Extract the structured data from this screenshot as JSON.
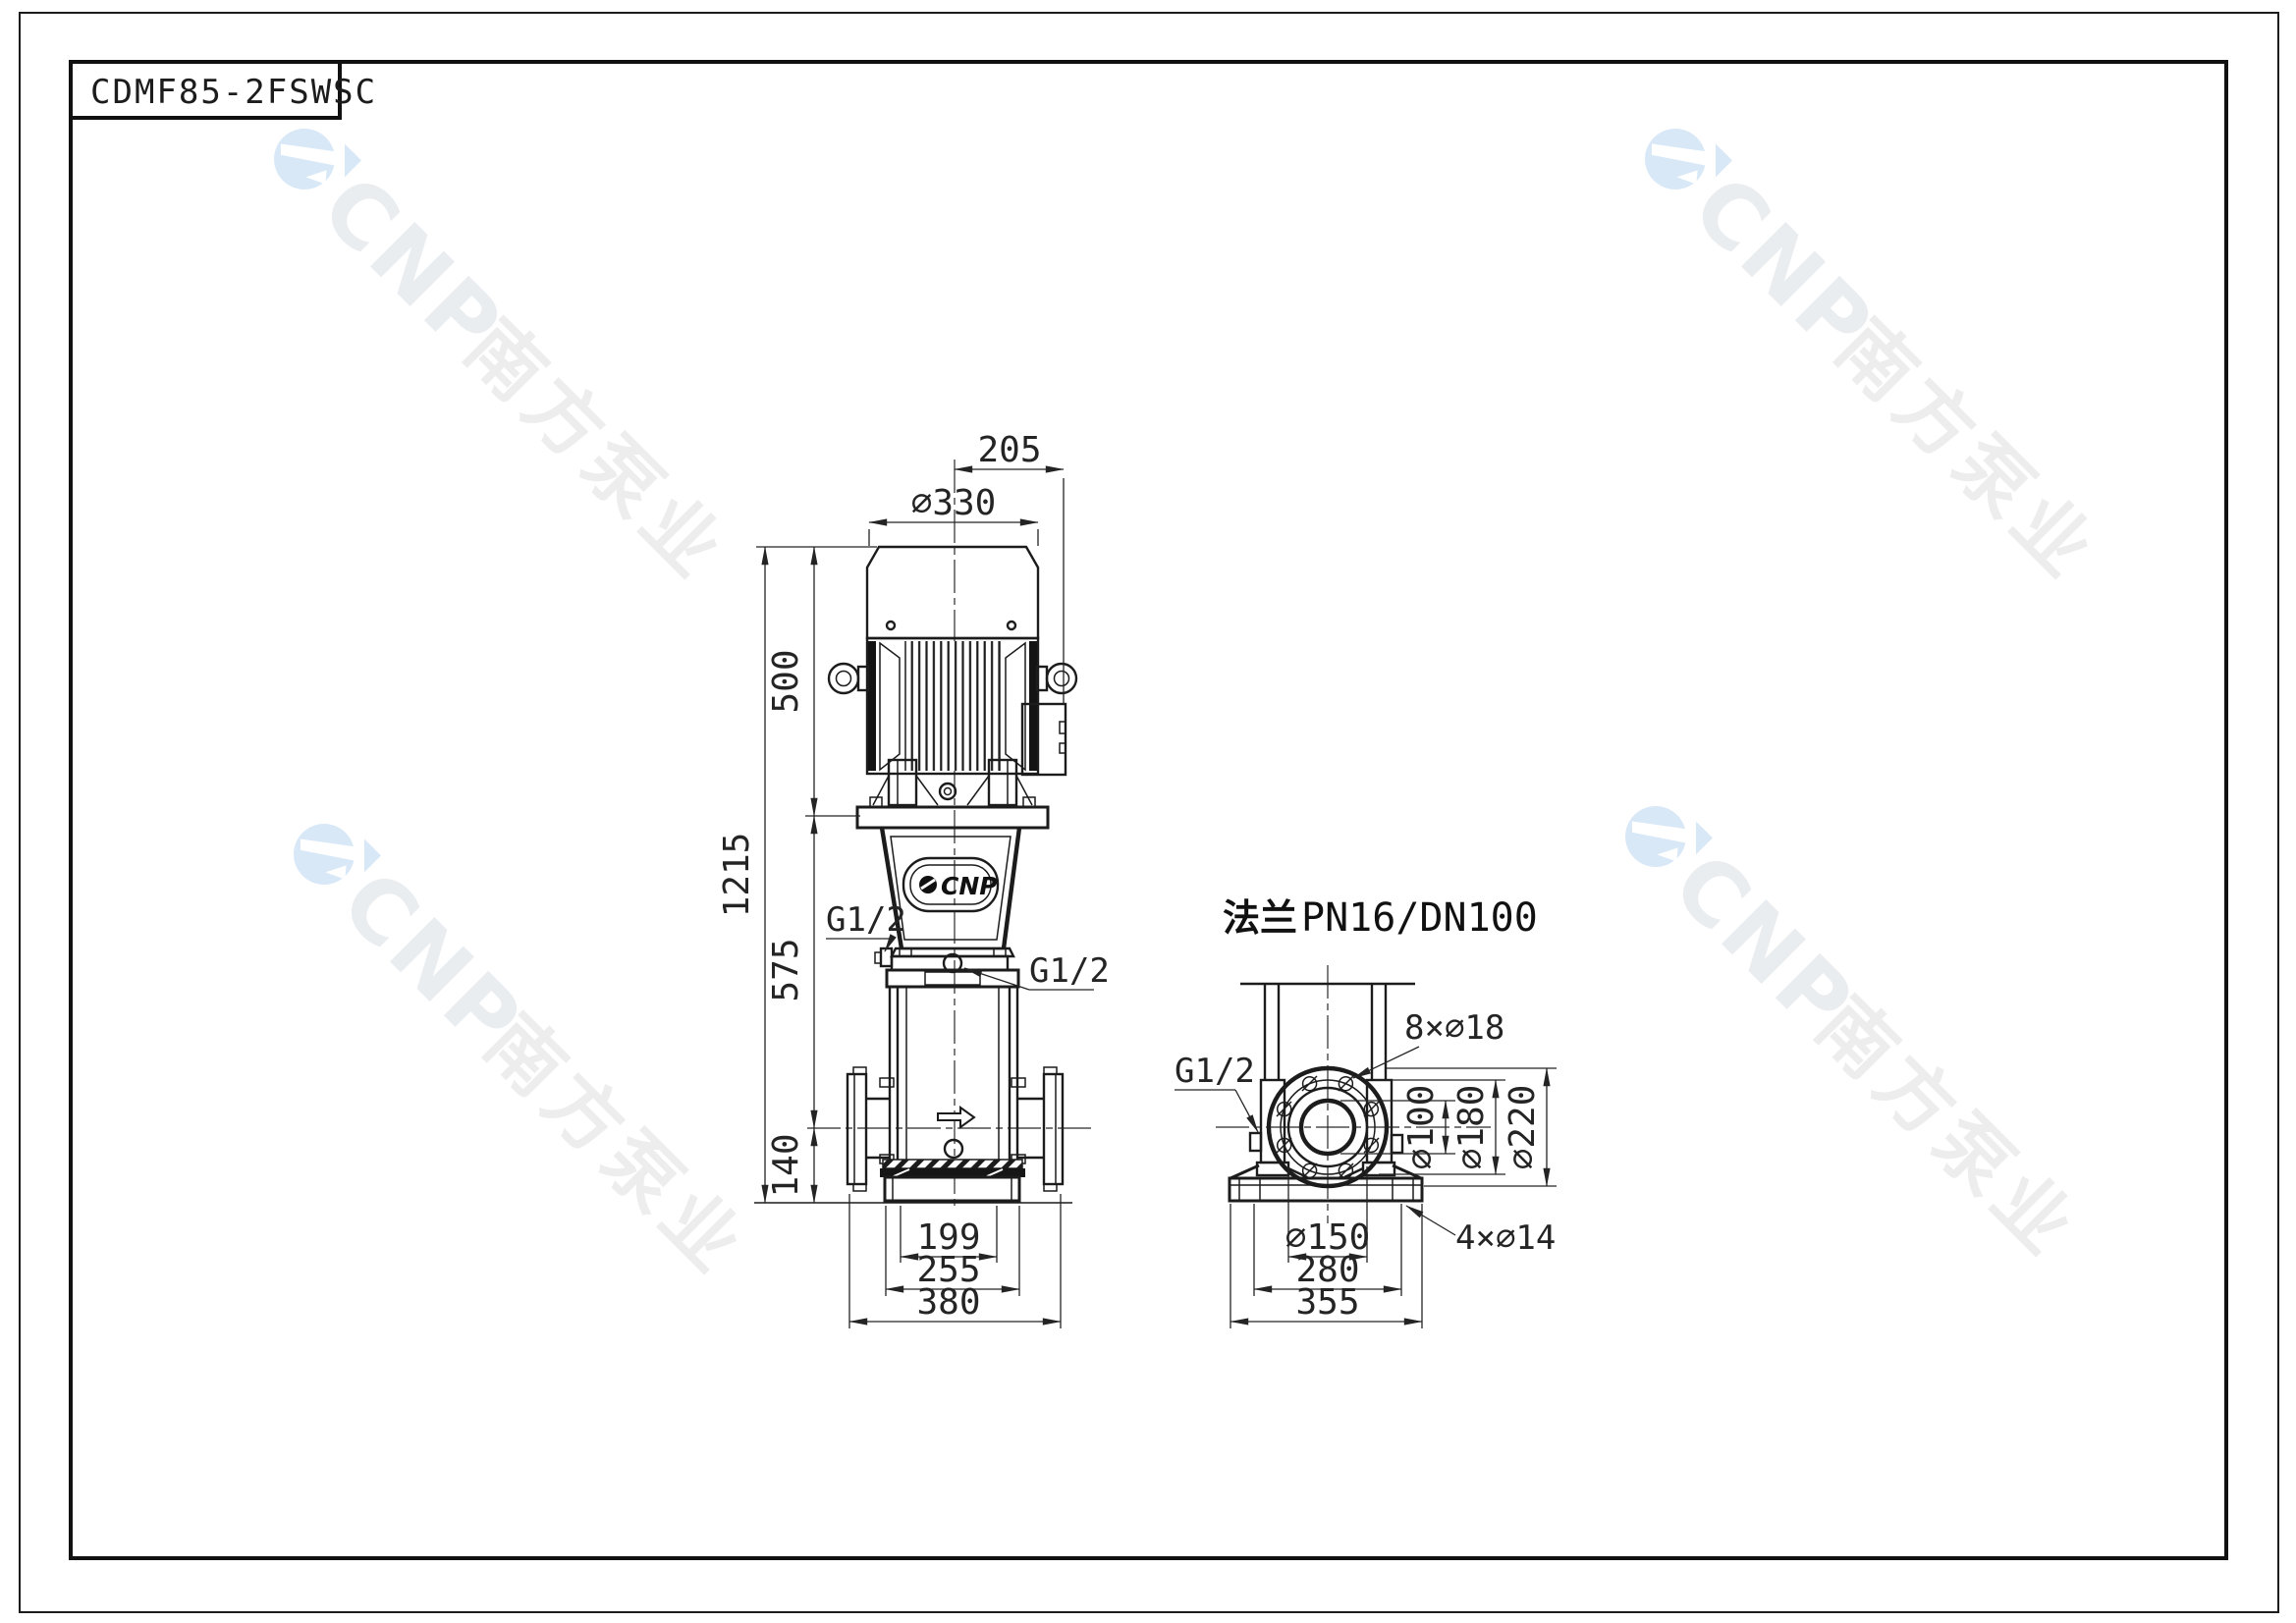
{
  "sheet": {
    "title": "CDMF85-2FSWSC"
  },
  "watermark": {
    "brand": "CNP",
    "company_cn": "南方泵业"
  },
  "front_view": {
    "badge_label": "CNP",
    "port_left": "G1/2",
    "port_right": "G1/2",
    "dims": {
      "shaft_offset": "205",
      "motor_diameter": "∅330",
      "motor_height": "500",
      "pump_body_height": "575",
      "inlet_height": "140",
      "total_height": "1215",
      "base_width_inner": "199",
      "base_width_mid": "255",
      "flange_span": "380"
    }
  },
  "side_view": {
    "flange_label_cn": "法兰",
    "flange_label_spec": "PN16/DN100",
    "port": "G1/2",
    "dims": {
      "bolt_holes": "8×∅18",
      "bore_diameter": "∅100",
      "bolt_circle_diameter": "∅180",
      "flange_outer_diameter": "∅220",
      "raised_face_diameter": "∅150",
      "anchor_span": "280",
      "base_width": "355",
      "anchor_holes": "4×∅14"
    }
  },
  "colors": {
    "line": "#1c1c1c",
    "dim": "#242424",
    "watermark_blue": "#d9e8f7",
    "watermark_gray": "#ebedef",
    "background": "#ffffff"
  }
}
